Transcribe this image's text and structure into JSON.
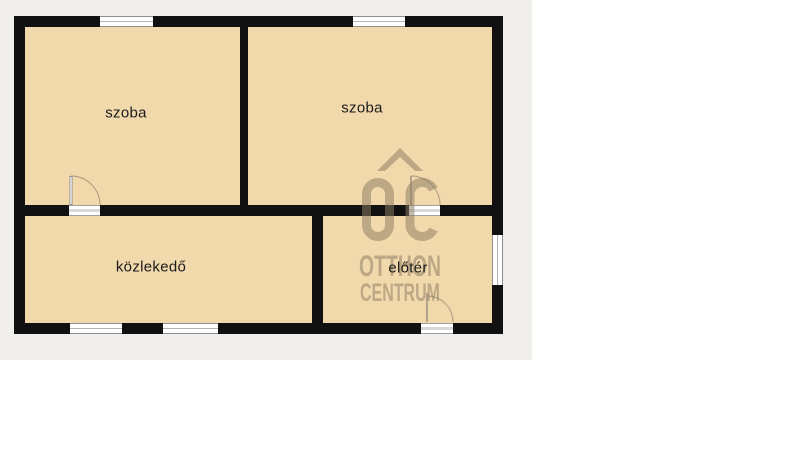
{
  "floorplan": {
    "title": "apartment floor plan",
    "rooms": [
      {
        "id": "szoba-left",
        "label": "szoba"
      },
      {
        "id": "szoba-right",
        "label": "szoba"
      },
      {
        "id": "kozlekedo",
        "label": "közlekedő"
      },
      {
        "id": "eloter",
        "label": "előtér"
      }
    ],
    "watermark": {
      "monogram": "OC",
      "line1": "OTTHON",
      "line2": "CENTRUM"
    },
    "counts": {
      "windows": 5,
      "doors": 3
    },
    "colors": {
      "floor_fill": "#f2d9ac",
      "wall": "#111111",
      "canvas_bg": "#f1efeb",
      "page_bg": "#ffffff",
      "watermark": "#8c7d63",
      "label_text": "#1b1b1b",
      "window_frame": "#8f8f8f",
      "door_arc": "#b3a387"
    }
  }
}
